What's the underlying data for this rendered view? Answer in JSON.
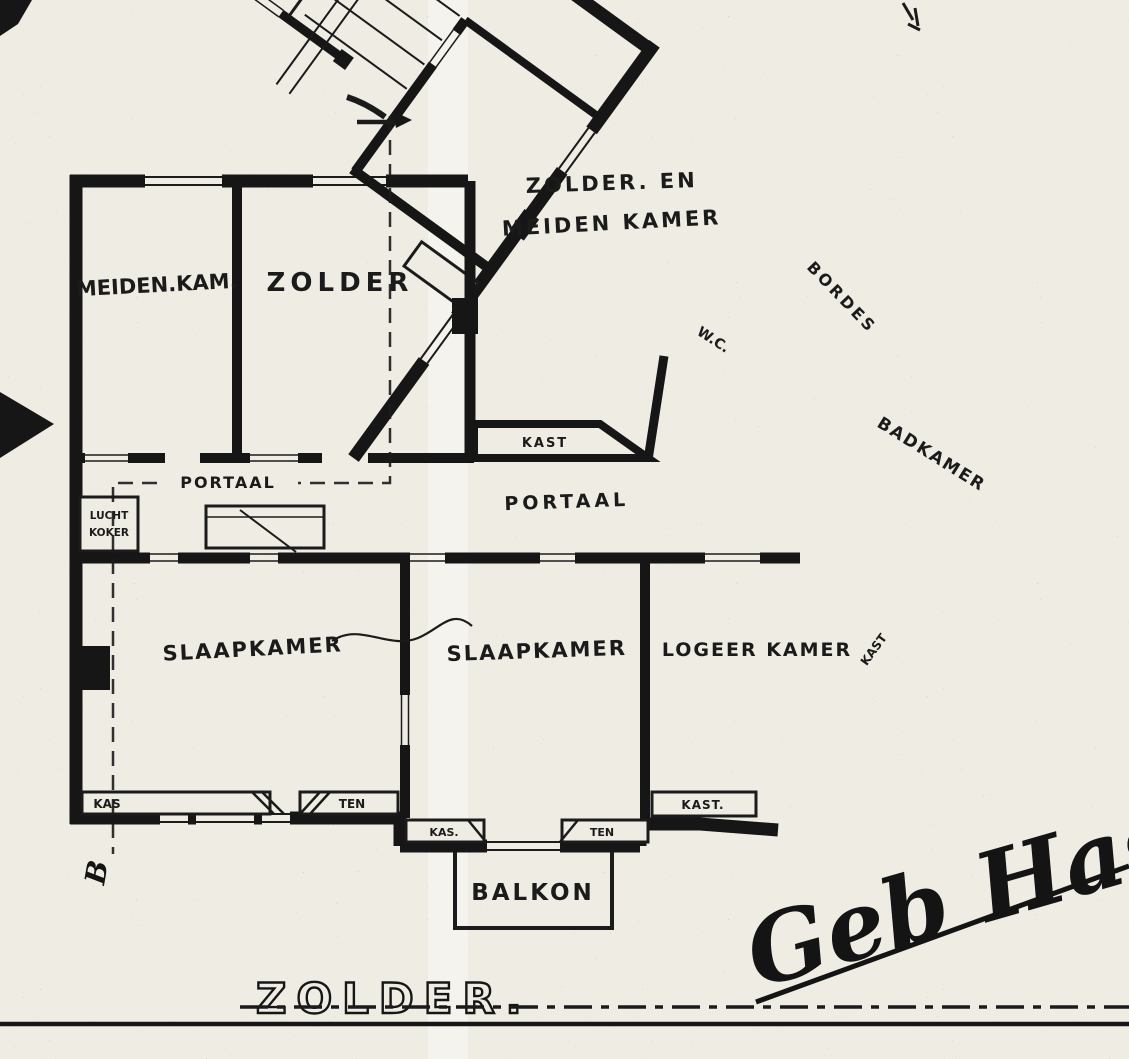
{
  "sheet": {
    "title": "ZOLDER.",
    "signature": "Geb Haspe",
    "section_marker_bottom": "B"
  },
  "rooms": {
    "meiden_kam": "MEIDEN.KAM.",
    "zolder": "ZOLDER",
    "zolder_en_line1": "ZOLDER. EN",
    "zolder_en_line2": "MEIDEN KAMER",
    "portaal_small": "PORTAAL",
    "portaal_main": "PORTAAL",
    "slaapkamer_left": "SLAAPKAMER",
    "slaapkamer_mid": "SLAAPKAMER",
    "logeer_kamer": "LOGEER KAMER",
    "badkamer": "BADKAMER",
    "bordes": "BORDES",
    "wc": "W.C.",
    "balkon": "BALKON"
  },
  "shafts": {
    "lucht_left_line1": "LUCHT",
    "lucht_left_line2": "KOKER",
    "lucht_wing_line1": "LUCHT",
    "lucht_wing_line2": "KOKER"
  },
  "closets": {
    "kast_top": "KAST",
    "kast_diag": "KAST",
    "kast_bottom": "KAST.",
    "kas_left": "KAS",
    "ten_left": "TEN",
    "kas_mid": "KAS.",
    "ten_mid": "TEN"
  },
  "colors": {
    "ink": "#161616",
    "paper": "#efece4"
  }
}
